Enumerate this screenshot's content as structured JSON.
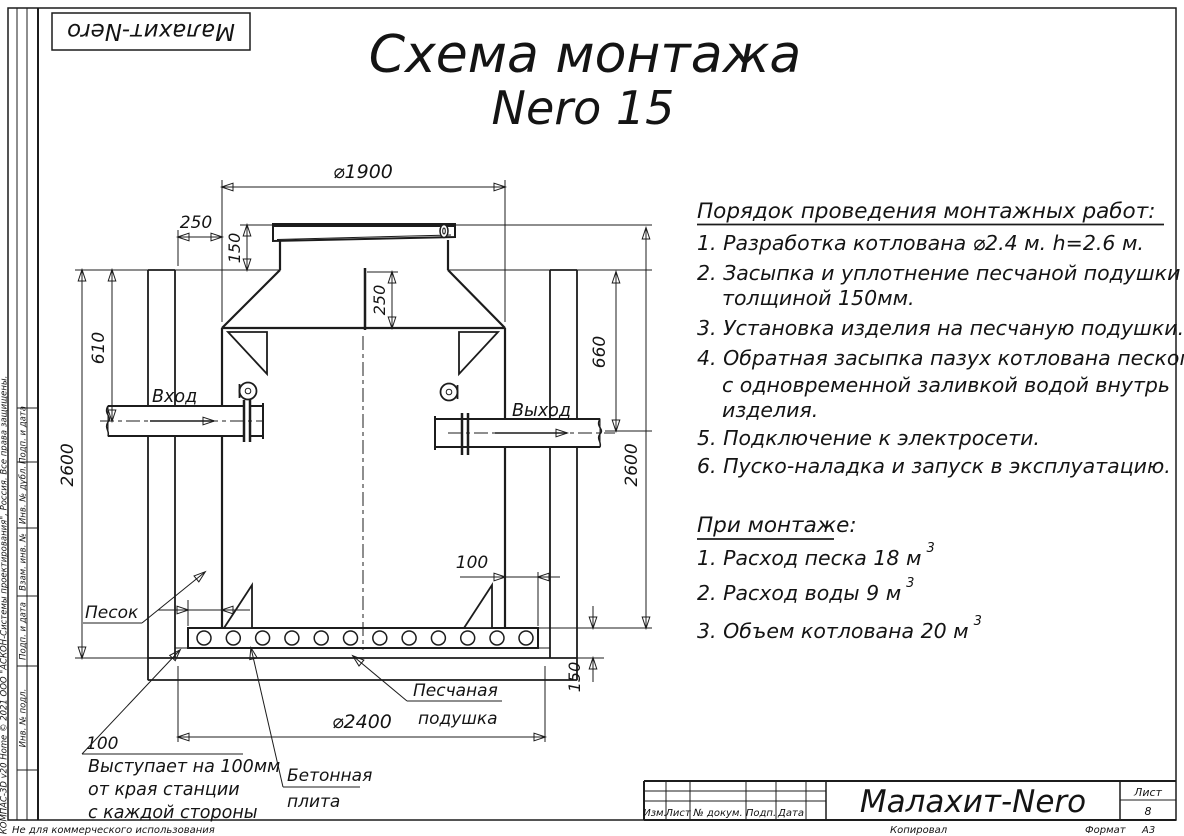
{
  "page": {
    "logo": "Малахит-Nero",
    "title_line1": "Схема монтажа",
    "title_line2": "Nero 15",
    "footer_note": "Не для коммерческого использования",
    "side_copyright": "КОМПАС-3D v20 Home © 2021 ООО \"АСКОН-Системы проектирования\", Россия. Все права защищены."
  },
  "stamp_column": {
    "cells": [
      "Подп. и дата",
      "Инв. № дубл.",
      "Взам. инв. №",
      "Подп. и дата",
      "Инв. № подл."
    ]
  },
  "title_block": {
    "col_izm": "Изм.",
    "col_list": "Лист",
    "col_doc": "№ докум.",
    "col_sign": "Подп.",
    "col_date": "Дата",
    "product": "Малахит-Nero",
    "sheet_label": "Лист",
    "sheet_number": "8",
    "copied": "Копировал",
    "format_label": "Формат",
    "format_value": "А3"
  },
  "instructions": {
    "heading": "Порядок проведения монтажных работ:",
    "lines": [
      "1. Разработка котлована ⌀2.4 м. h=2.6 м.",
      "2. Засыпка и уплотнение песчаной подушки",
      "толщиной 150мм.",
      "3. Установка изделия на песчаную подушки.",
      "4. Обратная засыпка пазух котлована песком,",
      "с одновременной заливкой водой внутрь",
      "изделия.",
      "5. Подключение к электросети.",
      "6. Пуско-наладка и запуск в эксплуатацию."
    ]
  },
  "during": {
    "heading": "При монтаже:",
    "items": [
      {
        "text": "1. Расход песка 18 м",
        "sup": "3"
      },
      {
        "text": "2. Расход воды 9 м",
        "sup": "3"
      },
      {
        "text": "3. Объем котлована 20 м",
        "sup": "3"
      }
    ]
  },
  "dims": {
    "top_diameter": "⌀1900",
    "backfill_width": "250",
    "lid_height": "150",
    "neck_depth": "250",
    "inlet_depth": "610",
    "outlet_depth": "660",
    "pit_depth_left": "2600",
    "pit_depth_right": "2600",
    "plate_overhang": "100",
    "overhang_left": "100",
    "cushion_thickness": "150",
    "pit_diameter": "⌀2400"
  },
  "labels": {
    "inlet": "Вход",
    "outlet": "Выход",
    "sand": "Песок",
    "cushion_line1": "Песчаная",
    "cushion_line2": "подушка",
    "plate_line1": "Бетонная",
    "plate_line2": "плита",
    "note_line1": "Выступает на 100мм",
    "note_line2": "от края станции",
    "note_line3": "с каждой стороны"
  }
}
